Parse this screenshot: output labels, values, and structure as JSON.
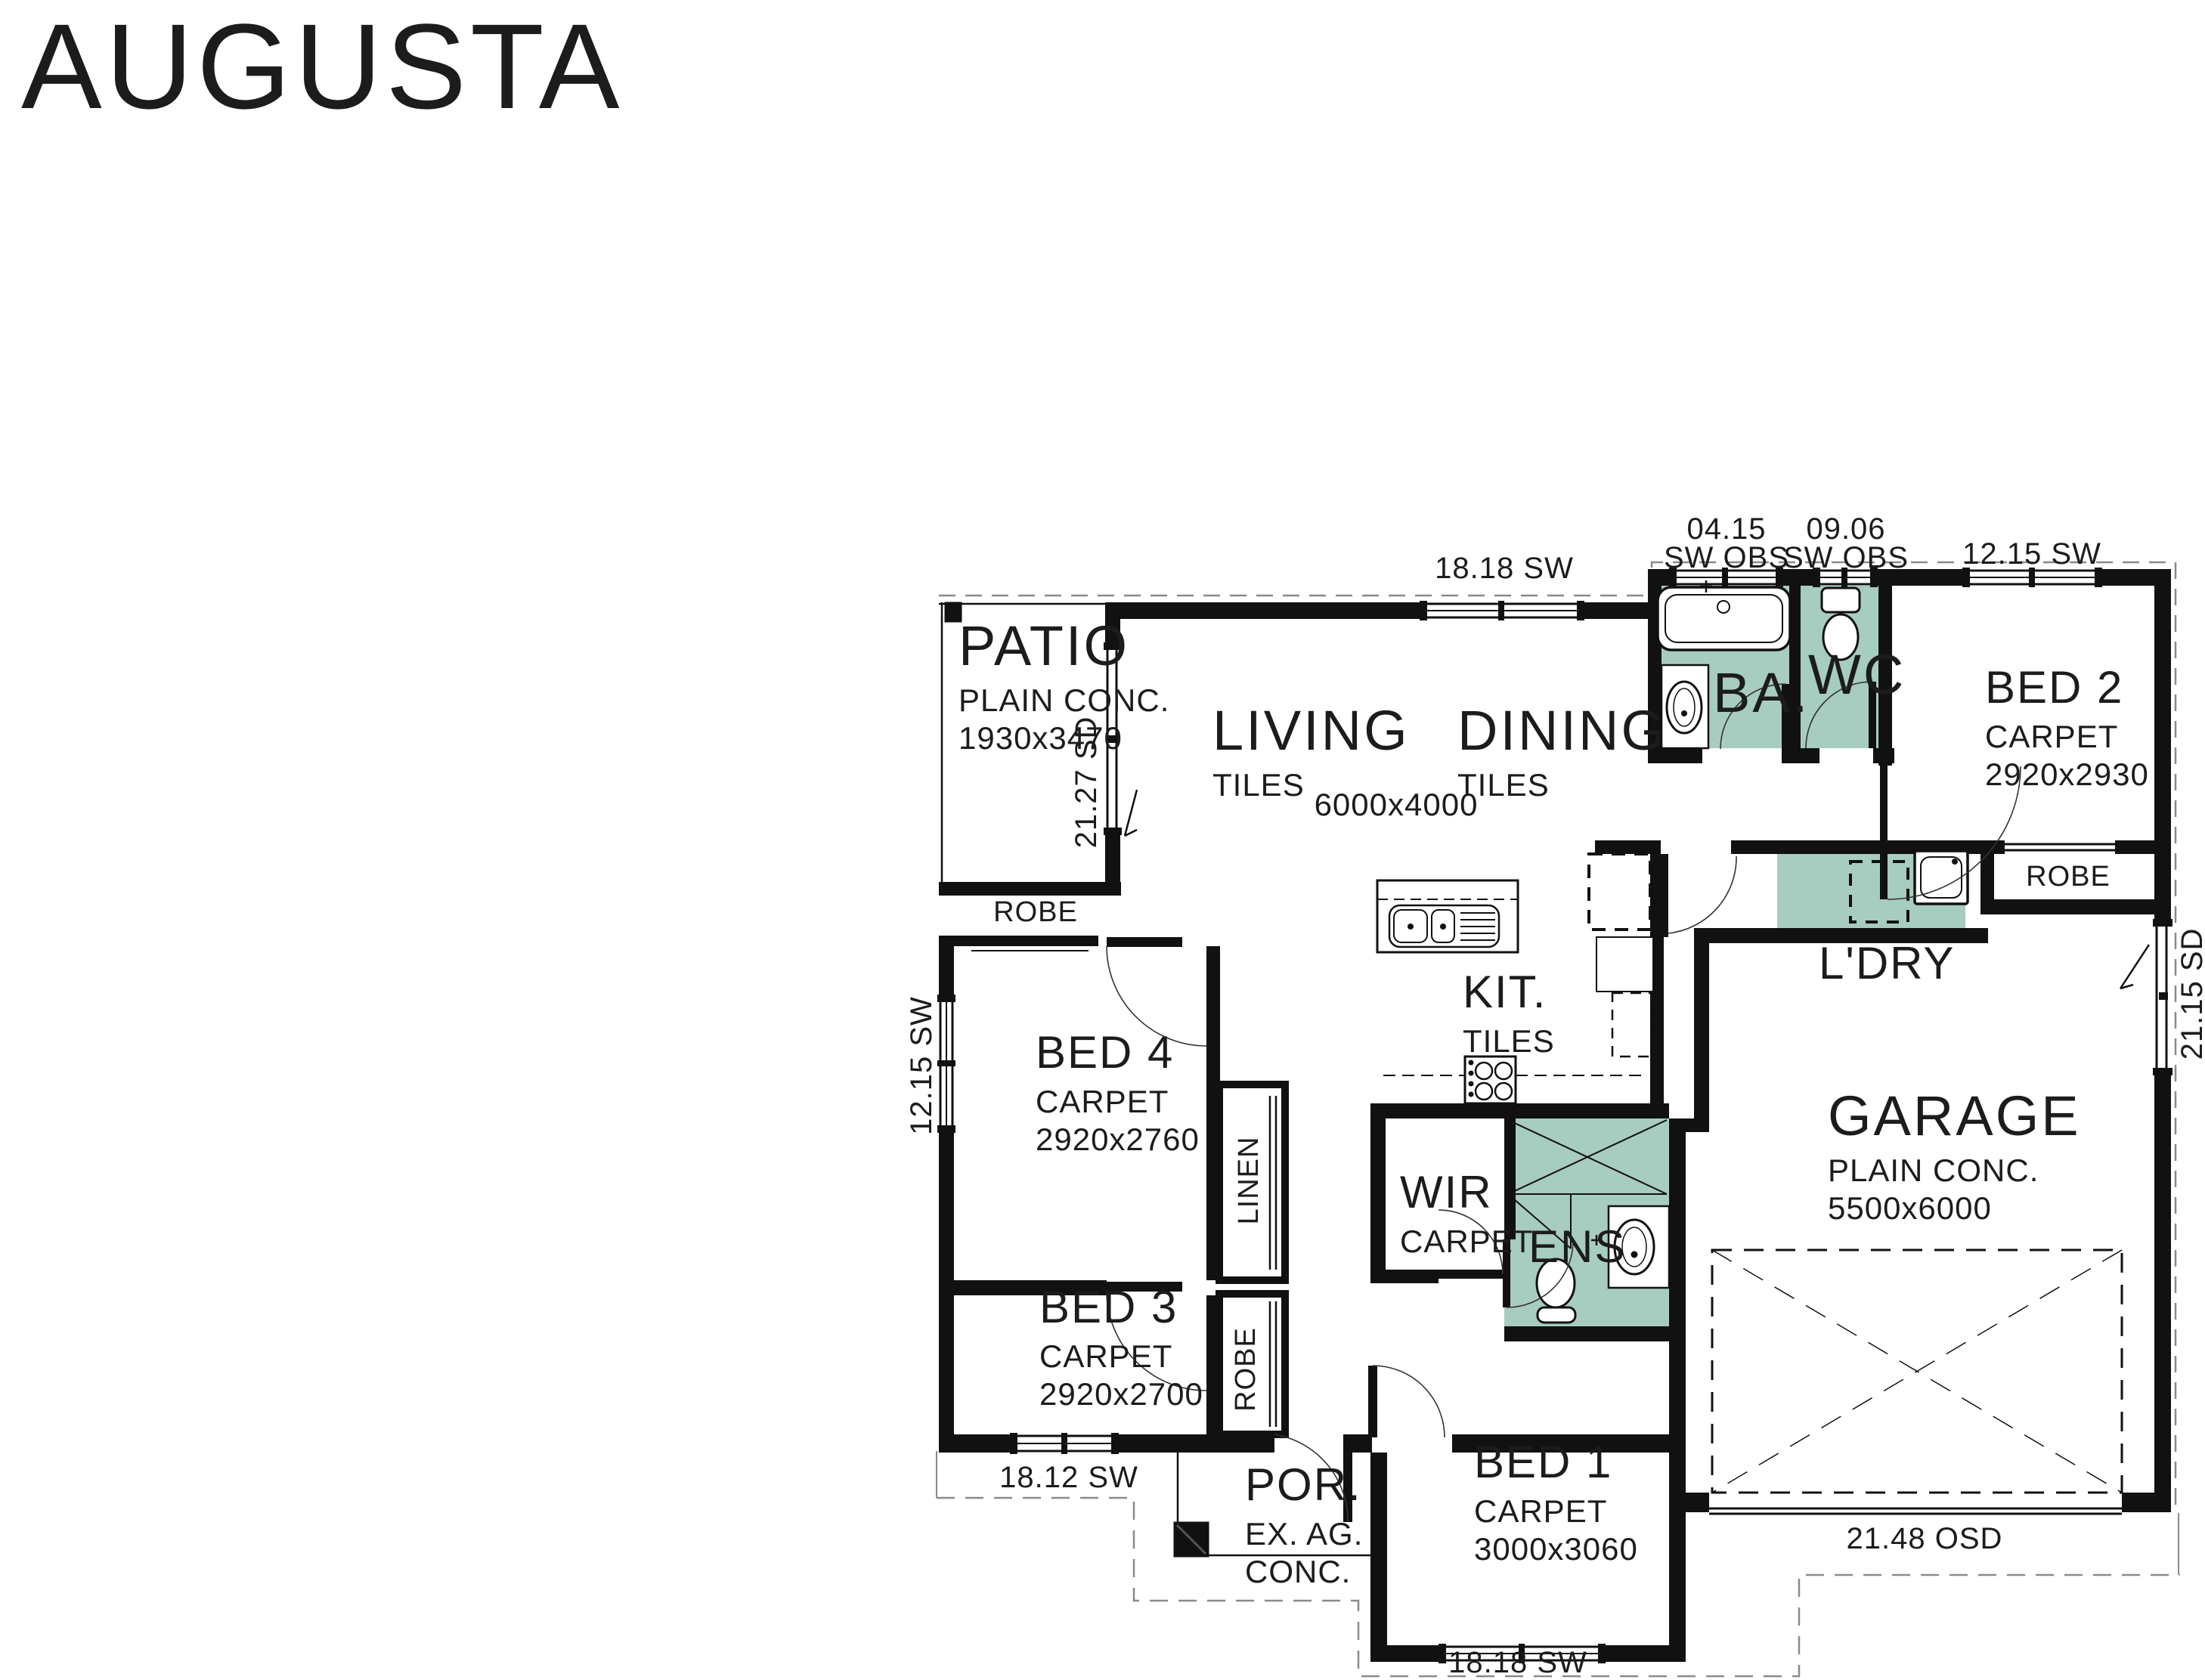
{
  "title": "AUGUSTA",
  "colors": {
    "wet_area_fill": "#a7ccc0",
    "wall": "#111111",
    "boundary_line": "#8a8a8a"
  },
  "rooms": {
    "patio": {
      "name": "PATIO",
      "finish": "PLAIN CONC.",
      "size": "1930x3470"
    },
    "living": {
      "name": "LIVING",
      "finish": "TILES"
    },
    "dining": {
      "name": "DINING",
      "finish": "TILES"
    },
    "living_dining_size": "6000x4000",
    "bath": {
      "name": "BA."
    },
    "wc": {
      "name": "WC"
    },
    "bed2": {
      "name": "BED 2",
      "finish": "CARPET",
      "size": "2920x2930"
    },
    "laundry": {
      "name": "L'DRY"
    },
    "kitchen": {
      "name": "KIT.",
      "finish": "TILES"
    },
    "garage": {
      "name": "GARAGE",
      "finish": "PLAIN CONC.",
      "size": "5500x6000"
    },
    "bed4": {
      "name": "BED 4",
      "finish": "CARPET",
      "size": "2920x2760"
    },
    "bed3": {
      "name": "BED 3",
      "finish": "CARPET",
      "size": "2920x2700"
    },
    "bed1": {
      "name": "BED 1",
      "finish": "CARPET",
      "size": "3000x3060"
    },
    "wir": {
      "name": "WIR",
      "finish": "CARPET"
    },
    "ens": {
      "name": "ENS"
    },
    "porch": {
      "name": "POR.",
      "line1": "EX. AG.",
      "line2": "CONC."
    },
    "robe_bed2": "ROBE",
    "robe_bed4": "ROBE",
    "robe_bed3": "ROBE",
    "linen": "LINEN"
  },
  "dimensions": {
    "top_living": "18.18 SW",
    "top_bath_num": "04.15",
    "top_bath_type": "SW OBS",
    "top_wc_num": "09.06",
    "top_wc_type": "SW OBS",
    "top_bed2": "12.15 SW",
    "left_patio": "21.27 SD",
    "left_bed4": "12.15 SW",
    "right_garage": "21.15 SD",
    "bottom_bed3": "18.12 SW",
    "bottom_garage": "21.48 OSD",
    "bottom_bed1": "18.18 SW"
  },
  "fixtures": [
    "bathtub",
    "bath-basin",
    "wc-toilet",
    "laundry-tub",
    "washer-space",
    "kitchen-island-sink",
    "cooktop",
    "fridge-space",
    "ens-shower",
    "ens-basin",
    "ens-toilet",
    "car-space",
    "porch-pier"
  ]
}
